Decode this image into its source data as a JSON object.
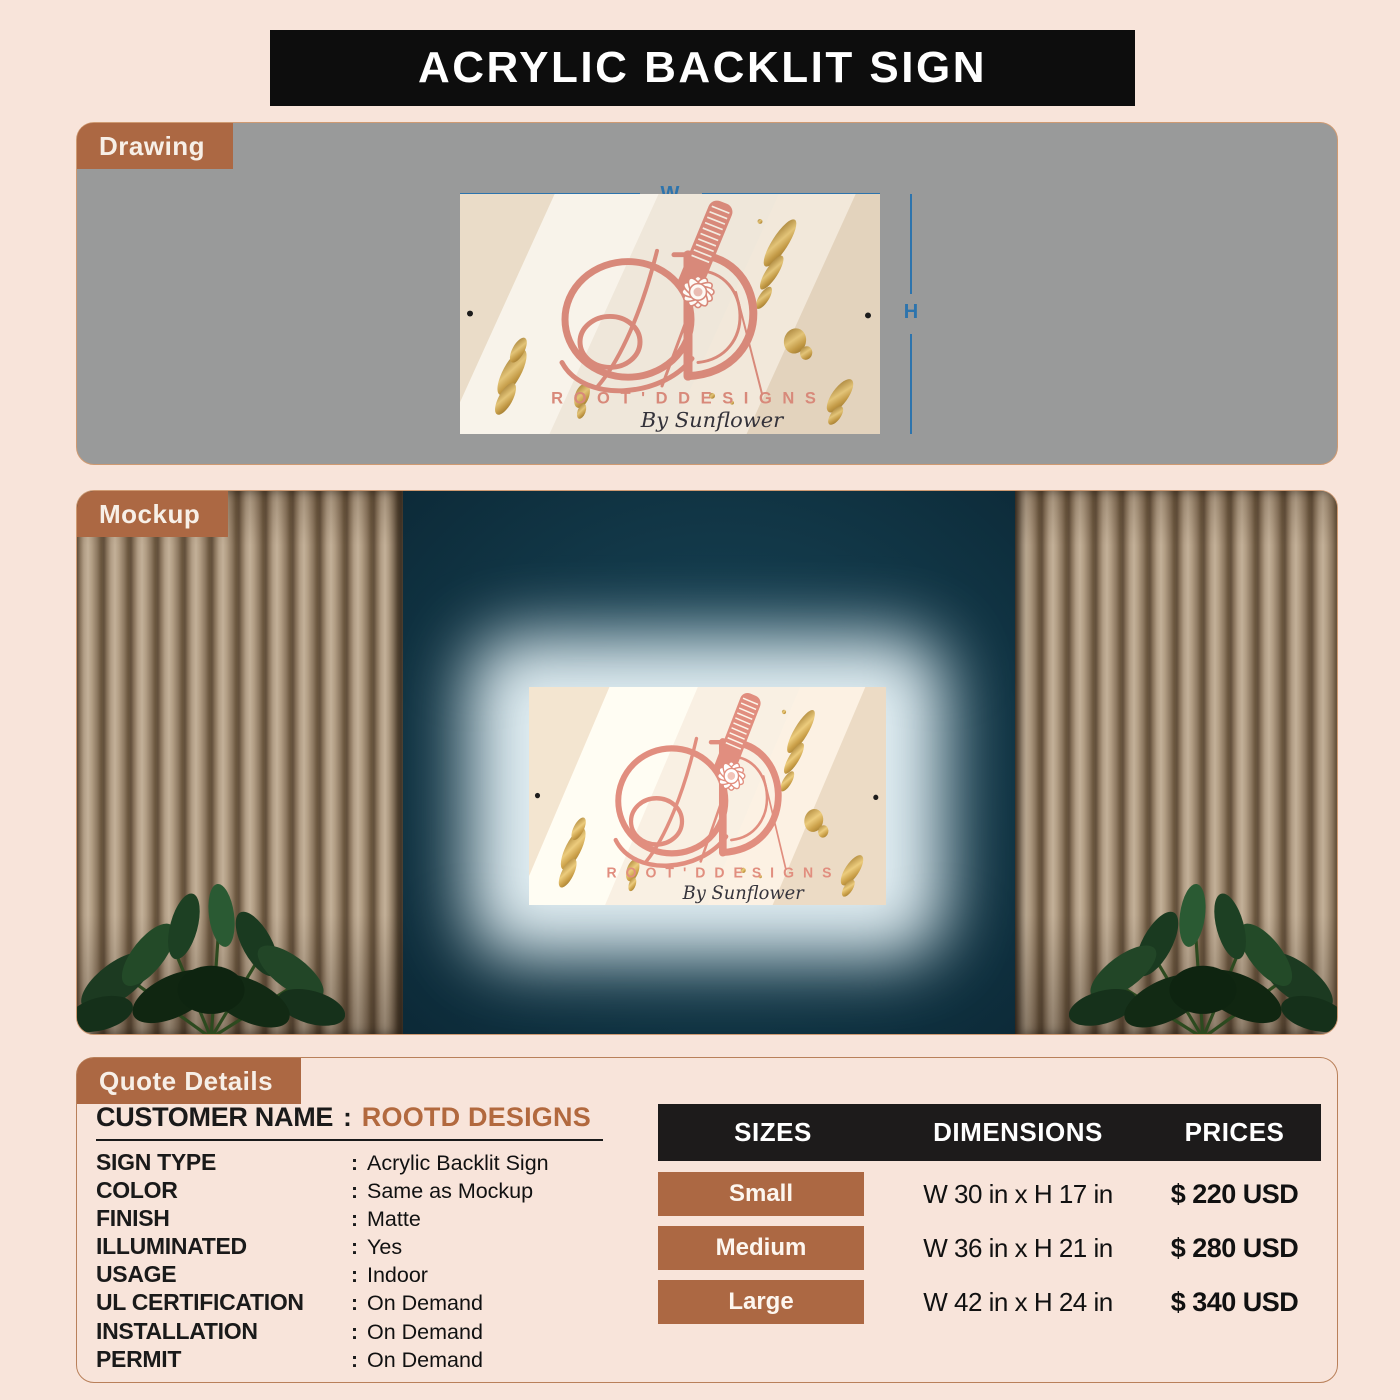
{
  "page": {
    "title": "ACRYLIC BACKLIT SIGN",
    "colors": {
      "background": "#f8e4da",
      "title_bar": "#0d0d0d",
      "tab_brown": "#ac6843",
      "drawing_gray": "#999a9a",
      "dimension_blue": "#2d74ad",
      "teal_wall": "#113546",
      "logo_salmon": "#d8897a",
      "customer_value_brown": "#b2693e",
      "table_header_black": "#1d1b1b"
    }
  },
  "drawing": {
    "tab_label": "Drawing",
    "width_label": "W",
    "height_label": "H"
  },
  "mockup": {
    "tab_label": "Mockup"
  },
  "sign": {
    "brand_line": "R O O T ' D   D E S I G N S",
    "script_line": "By Sunflower"
  },
  "quote": {
    "tab_label": "Quote Details",
    "separator": ":",
    "customer_label": "CUSTOMER NAME",
    "customer_value": "ROOTD DESIGNS",
    "fields": [
      {
        "label": "SIGN TYPE",
        "value": "Acrylic Backlit Sign"
      },
      {
        "label": "COLOR",
        "value": "Same as Mockup"
      },
      {
        "label": "FINISH",
        "value": "Matte"
      },
      {
        "label": "ILLUMINATED",
        "value": "Yes"
      },
      {
        "label": "USAGE",
        "value": "Indoor"
      },
      {
        "label": "UL CERTIFICATION",
        "value": "On Demand"
      },
      {
        "label": "INSTALLATION",
        "value": "On Demand"
      },
      {
        "label": "PERMIT",
        "value": "On Demand"
      }
    ]
  },
  "pricing": {
    "headers": [
      "SIZES",
      "DIMENSIONS",
      "PRICES"
    ],
    "rows": [
      {
        "size": "Small",
        "dimensions": "W 30 in x H 17 in",
        "price": "$ 220 USD"
      },
      {
        "size": "Medium",
        "dimensions": "W 36 in x H 21 in",
        "price": "$ 280 USD"
      },
      {
        "size": "Large",
        "dimensions": "W 42 in x H 24 in",
        "price": "$ 340 USD"
      }
    ]
  }
}
